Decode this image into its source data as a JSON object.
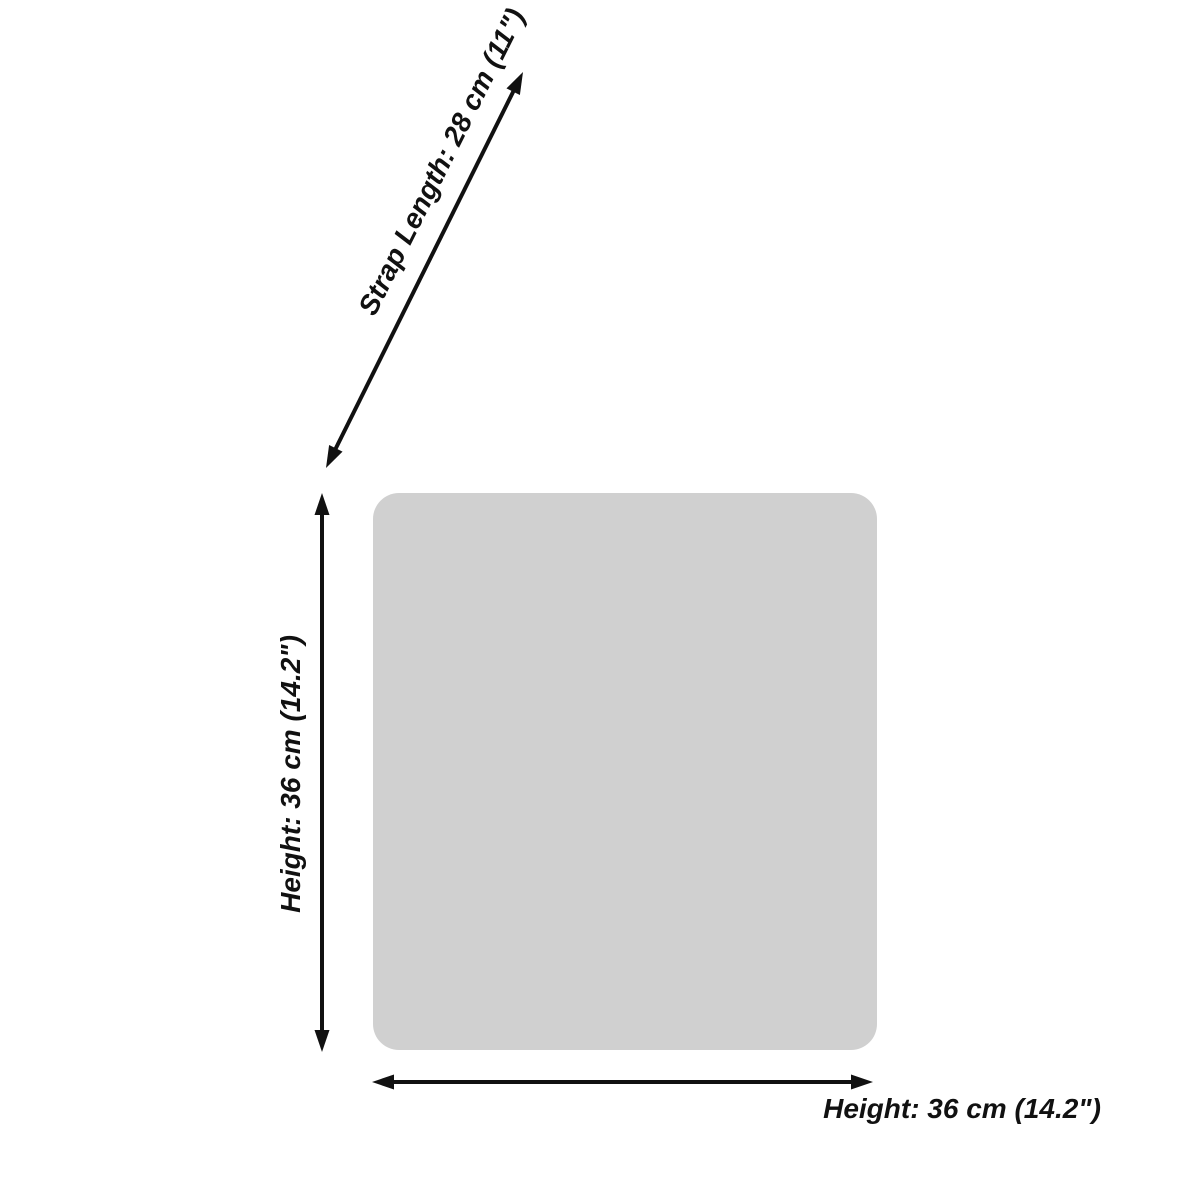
{
  "diagram": {
    "type": "product-dimension-diagram",
    "subject": "tote-bag-silhouette",
    "colors": {
      "shape_fill": "#d0d0d0",
      "annotation": "#111111",
      "background": "#ffffff"
    },
    "annotations": {
      "strap_length": {
        "label": "Strap Length: 28 cm (11\")",
        "value_cm": "28",
        "value_in": "11\""
      },
      "height": {
        "label": "Height: 36 cm (14.2\")",
        "value_cm": "36",
        "value_in": "14.2\""
      },
      "bottom_width": {
        "label": "Height: 36 cm (14.2\")",
        "value_cm": "36",
        "value_in": "14.2\""
      }
    }
  }
}
